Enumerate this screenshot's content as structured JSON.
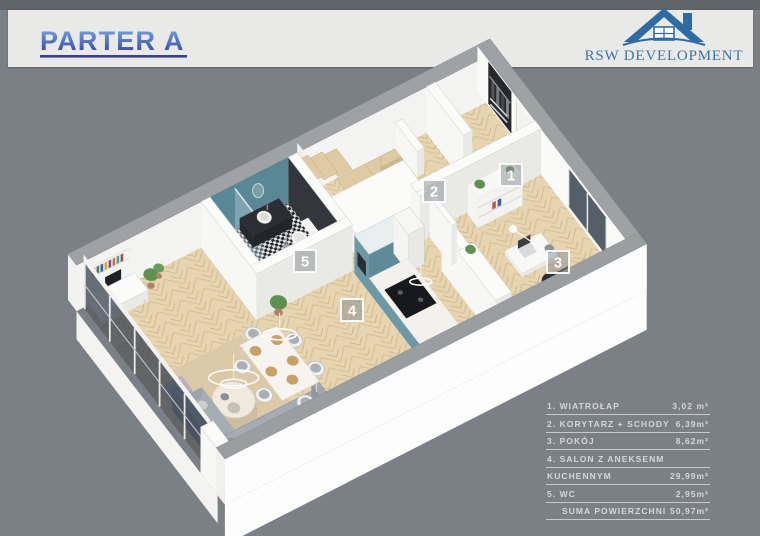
{
  "header": {
    "title": "PARTER A",
    "title_color_top": "#7cabe8",
    "title_color_bottom": "#2c3e9a",
    "underline_color": "#3c3f92",
    "band_color": "#e9e9e7"
  },
  "logo": {
    "company": "RSW DEVELOPMENT",
    "text_color": "#3e74a8",
    "roof_dark": "#2f6ba3",
    "roof_light": "#4a86bb"
  },
  "plan": {
    "floor_color": "#e7d5b2",
    "accent_teal": "#6d98a6",
    "wc_accent": "#5a8796",
    "markers": [
      {
        "id": "1",
        "room": "wiatrolap"
      },
      {
        "id": "2",
        "room": "korytarz-schody"
      },
      {
        "id": "3",
        "room": "pokoj"
      },
      {
        "id": "4",
        "room": "salon-z-aneksem-kuchennym"
      },
      {
        "id": "5",
        "room": "wc"
      }
    ]
  },
  "legend": {
    "rows": [
      {
        "label": "1. WIATROŁAP",
        "area": "3,02 m²"
      },
      {
        "label": "2. KORYTARZ + SCHODY",
        "area": "6,39m²"
      },
      {
        "label": "3. POKÓJ",
        "area": "8,62m²"
      },
      {
        "label": "4. SALON Z ANEKSENM",
        "area": ""
      },
      {
        "label": "KUCHENNYM",
        "area": "29,99m²"
      },
      {
        "label": "5. WC",
        "area": "2,95m²"
      },
      {
        "label": "SUMA POWIERZCHNI",
        "area": "50,97m²"
      }
    ]
  }
}
